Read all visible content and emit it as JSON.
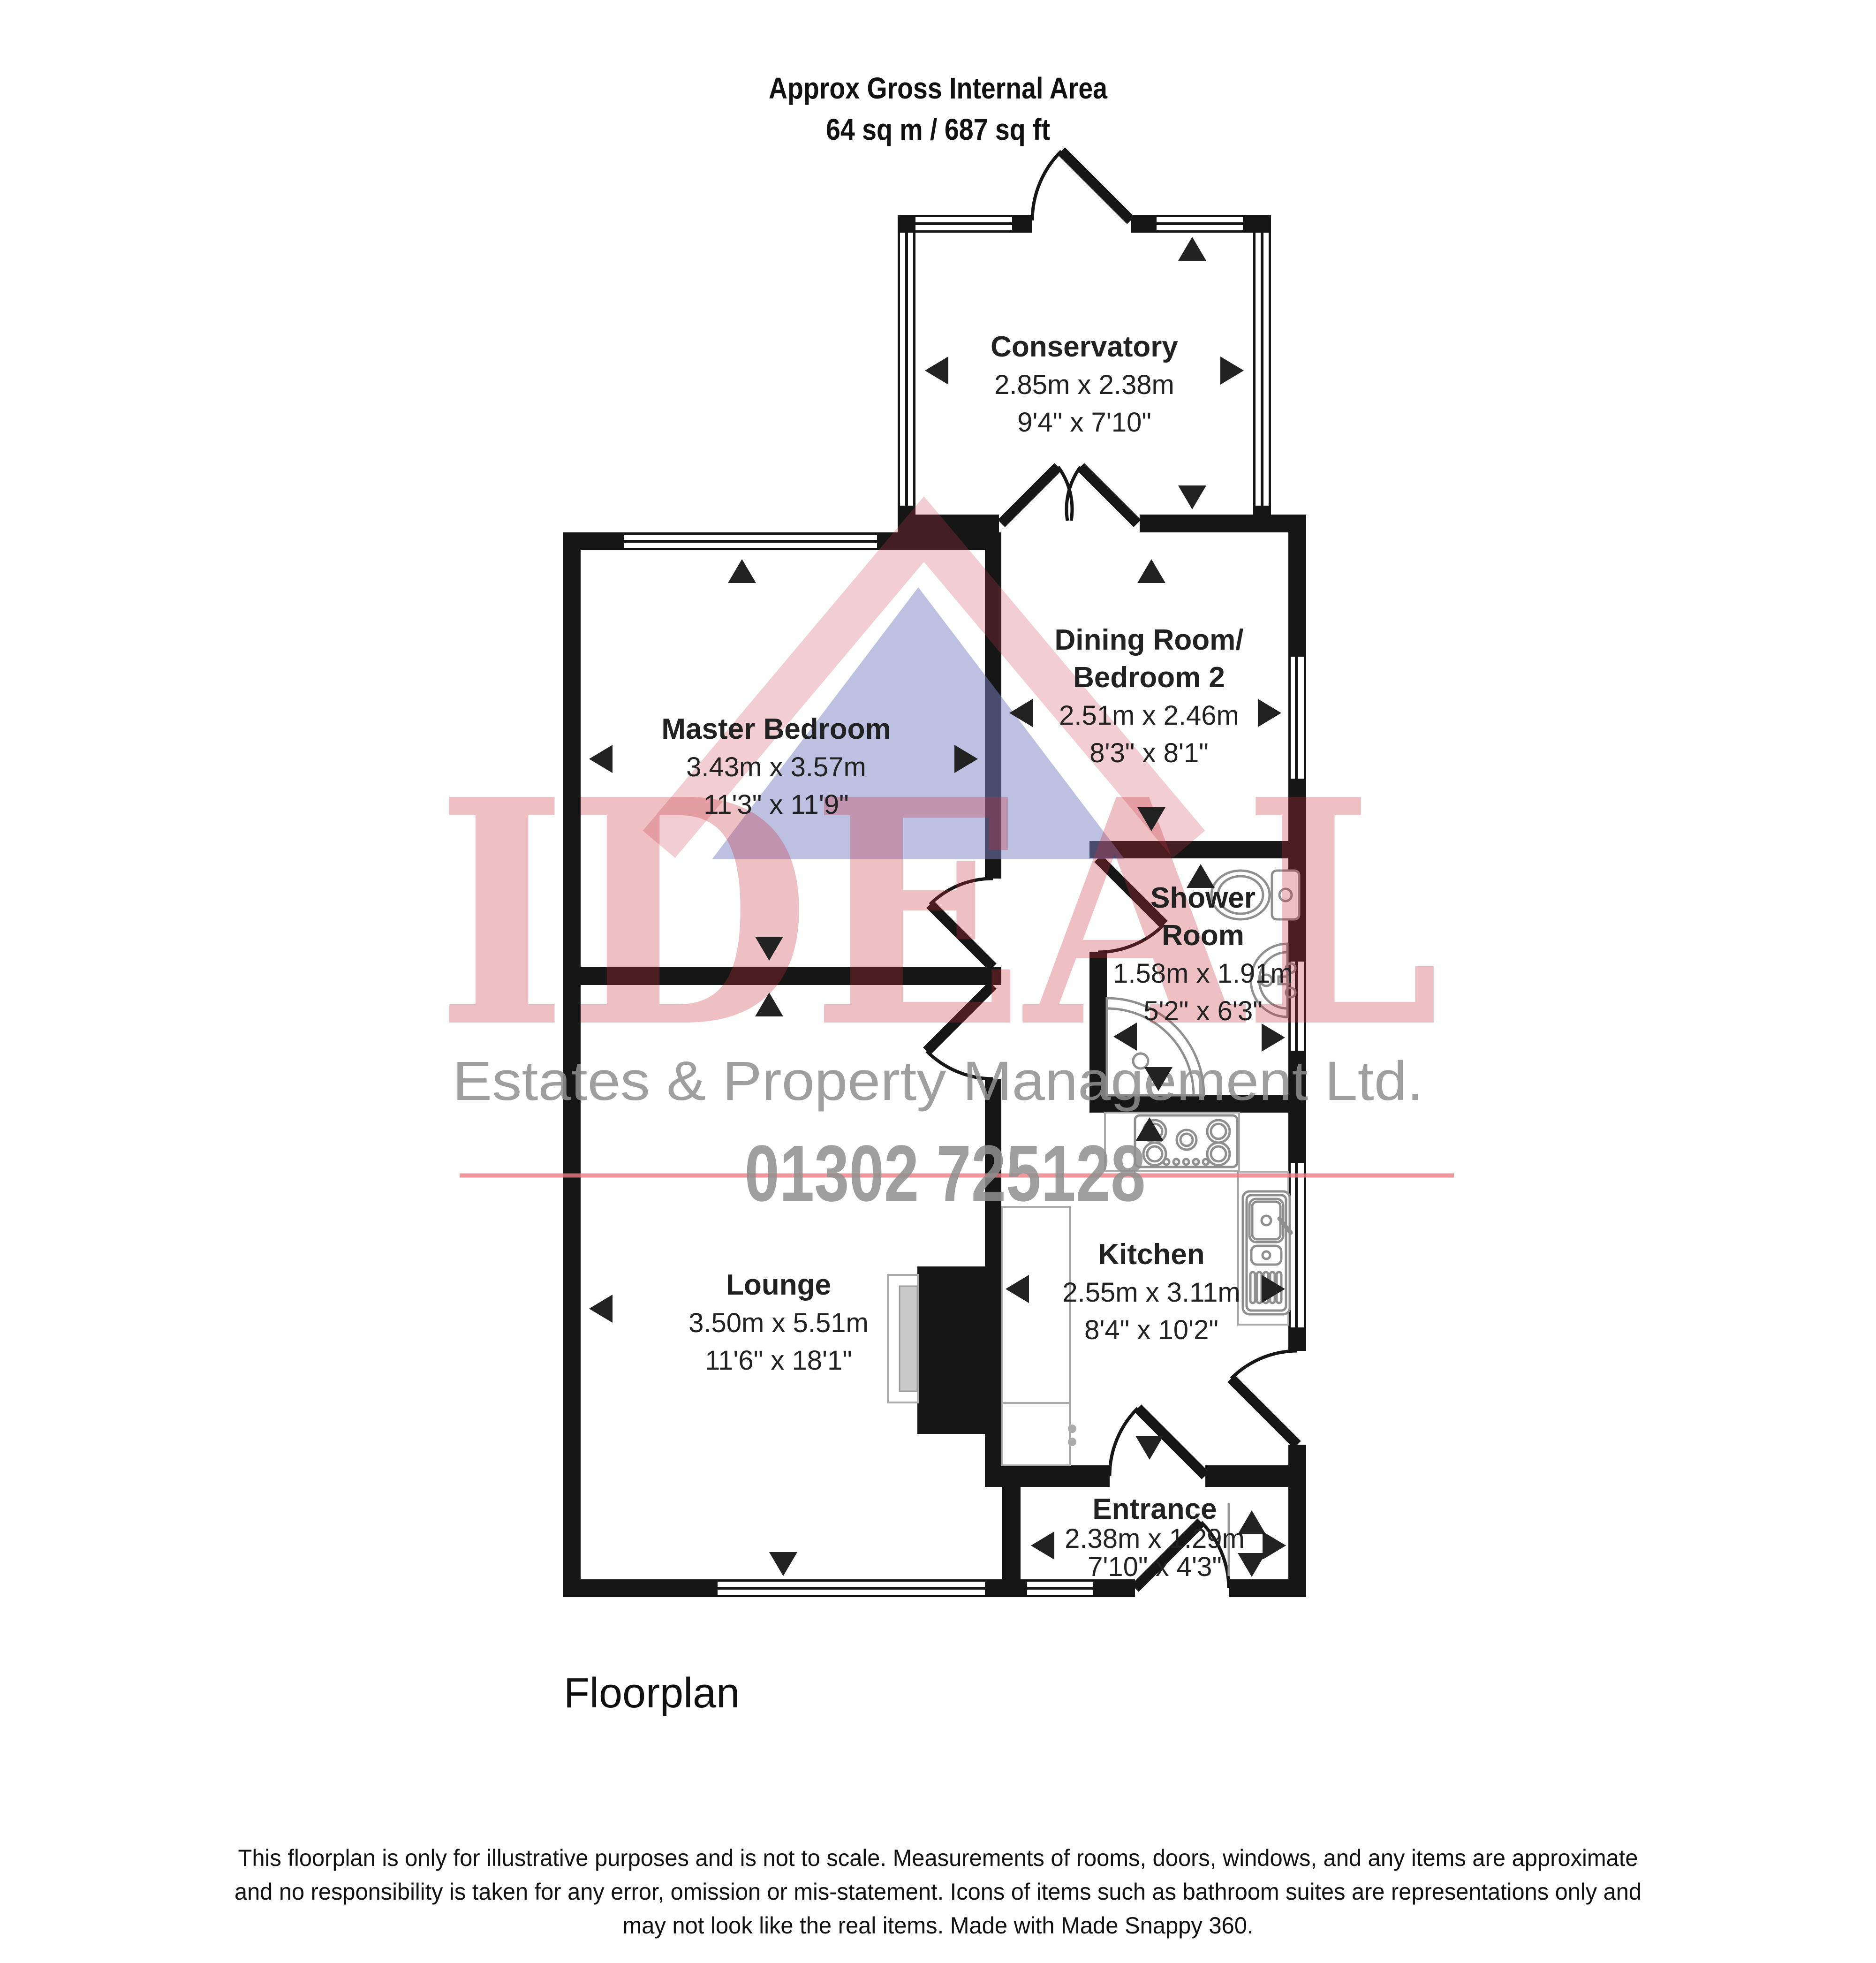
{
  "header": {
    "line1": "Approx Gross Internal Area",
    "line2": "64 sq m / 687 sq ft"
  },
  "rooms": [
    {
      "name": "Conservatory",
      "dims_metric": "2.85m x 2.38m",
      "dims_imperial": "9'4\" x 7'10\""
    },
    {
      "name": "Master Bedroom",
      "dims_metric": "3.43m x 3.57m",
      "dims_imperial": "11'3\" x 11'9\""
    },
    {
      "name_line1": "Dining Room/",
      "name_line2": "Bedroom 2",
      "dims_metric": "2.51m x 2.46m",
      "dims_imperial": "8'3\" x 8'1\""
    },
    {
      "name_line1": "Shower",
      "name_line2": "Room",
      "dims_metric": "1.58m x 1.91m",
      "dims_imperial": "5'2\" x 6'3\""
    },
    {
      "name": "Kitchen",
      "dims_metric": "2.55m x 3.11m",
      "dims_imperial": "8'4\" x 10'2\""
    },
    {
      "name": "Lounge",
      "dims_metric": "3.50m x 5.51m",
      "dims_imperial": "11'6\" x 18'1\""
    },
    {
      "name": "Entrance",
      "dims_metric": "2.38m x 1.29m",
      "dims_imperial": "7'10\" x 4'3\""
    }
  ],
  "watermark": {
    "brand": "IDEAL",
    "tagline": "Estates & Property Management Ltd.",
    "phone": "01302 725128"
  },
  "footer": {
    "label": "Floorplan"
  },
  "disclaimer": {
    "line1": "This floorplan is only for illustrative purposes and is not to scale. Measurements of rooms, doors, windows, and any items are approximate",
    "line2": "and no responsibility is taken for any error, omission or mis-statement. Icons of items such as bathroom suites are representations only and",
    "line3": "may not look like the real items. Made with Made Snappy 360."
  },
  "colors": {
    "wall": "#161616",
    "watermark_pink": "#e2505c",
    "watermark_blue": "#7b84c4",
    "watermark_gray": "#8f8f8f",
    "fixture_gray": "#8f8f8f"
  }
}
